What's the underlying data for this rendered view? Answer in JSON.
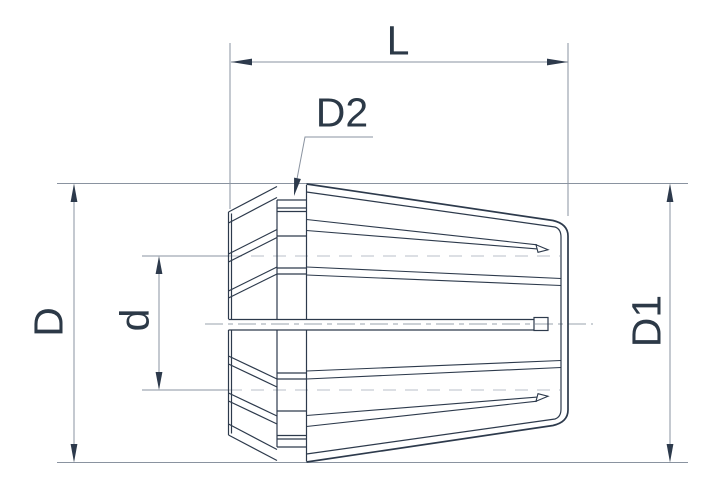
{
  "diagram": {
    "type": "technical-drawing",
    "subject": "ER collet side view with dimension callouts",
    "labels": {
      "length": "L",
      "rear_diameter": "D",
      "bore_diameter": "d",
      "front_diameter": "D1",
      "groove_diameter": "D2"
    },
    "colors": {
      "background": "#ffffff",
      "outline": "#2d3a4c",
      "dimension_line": "#8a93a0",
      "centerline": "#9aa3ae",
      "hidden_line": "#c6ccd4",
      "text": "#2c3947"
    }
  }
}
